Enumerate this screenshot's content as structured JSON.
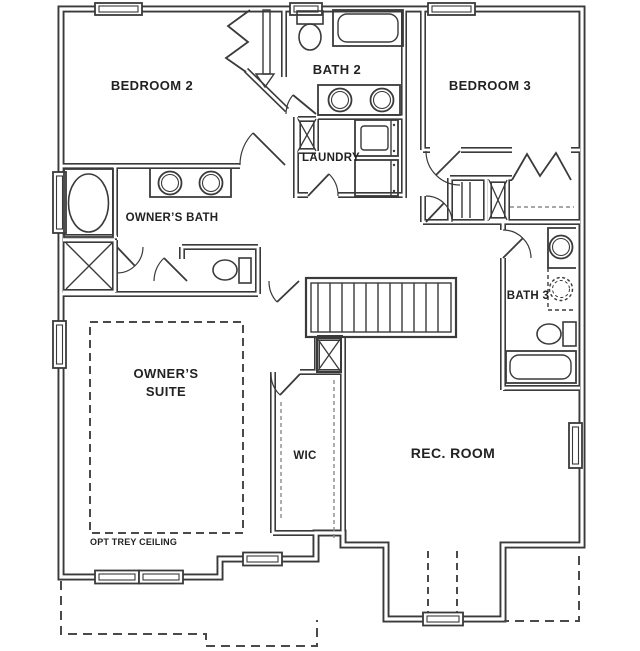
{
  "plan": {
    "title": "Second floor plan",
    "rooms": {
      "bedroom2": "BEDROOM 2",
      "bath2": "BATH 2",
      "bedroom3": "BEDROOM 3",
      "laundry": "LAUNDRY",
      "owners_bath": "OWNER’S BATH",
      "bath3": "BATH 3",
      "owners_suite1": "OWNER’S",
      "owners_suite2": "SUITE",
      "wic": "WIC",
      "rec_room": "REC. ROOM"
    },
    "annotations": {
      "trey": "OPT TREY CEILING"
    },
    "colors": {
      "wall": "#3a3a3a",
      "background": "#ffffff",
      "text": "#222222",
      "dash_gray": "#8a8a8a"
    },
    "fixtures": [
      "oval-tub",
      "shower",
      "double-vanity-owners",
      "toilet-owners",
      "toilet-bath2",
      "tub-bath2",
      "double-vanity-bath2",
      "washer",
      "dryer",
      "stairs",
      "vanity-bath3",
      "optional-sink-bath3",
      "toilet-bath3",
      "tub-bath3"
    ]
  }
}
